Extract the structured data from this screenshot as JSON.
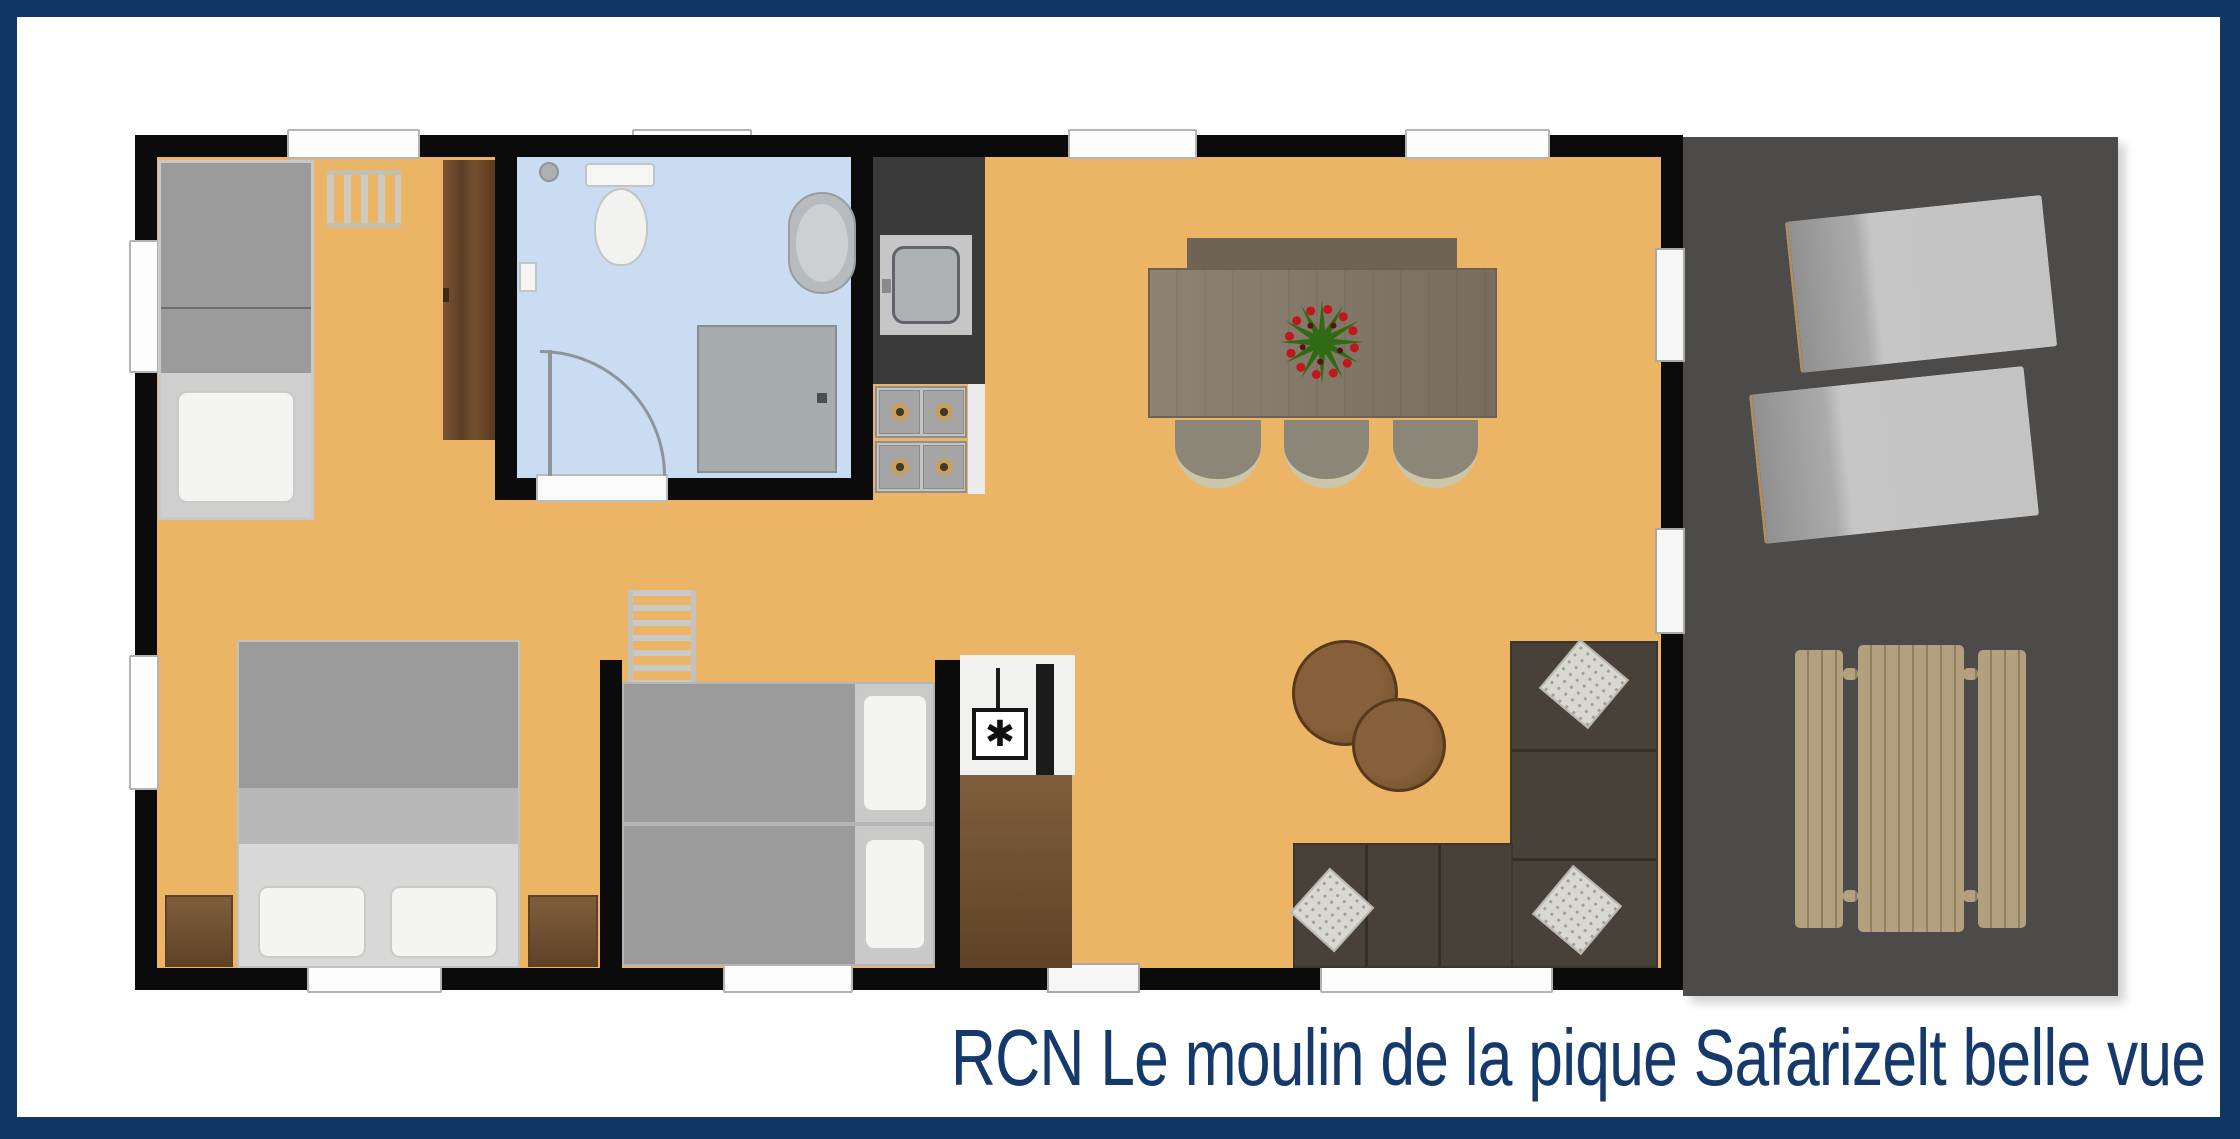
{
  "caption": "RCN Le moulin de la pique Safarizelt belle vue",
  "symbols": {
    "stove": "✱"
  },
  "theme": {
    "frame_navy": "#113764",
    "caption_navy": "#16396b",
    "floor_orange": "#ecb566",
    "wall_black": "#0b0b0b",
    "bathroom_blue": "#c9dcf1",
    "terrace_gray": "#4c4b49",
    "wood_brown": "#6d4b31",
    "furniture_gray": "#9b9b9b",
    "sofa_brown": "#474138",
    "deck_wood_tan": "#b2a07f"
  }
}
